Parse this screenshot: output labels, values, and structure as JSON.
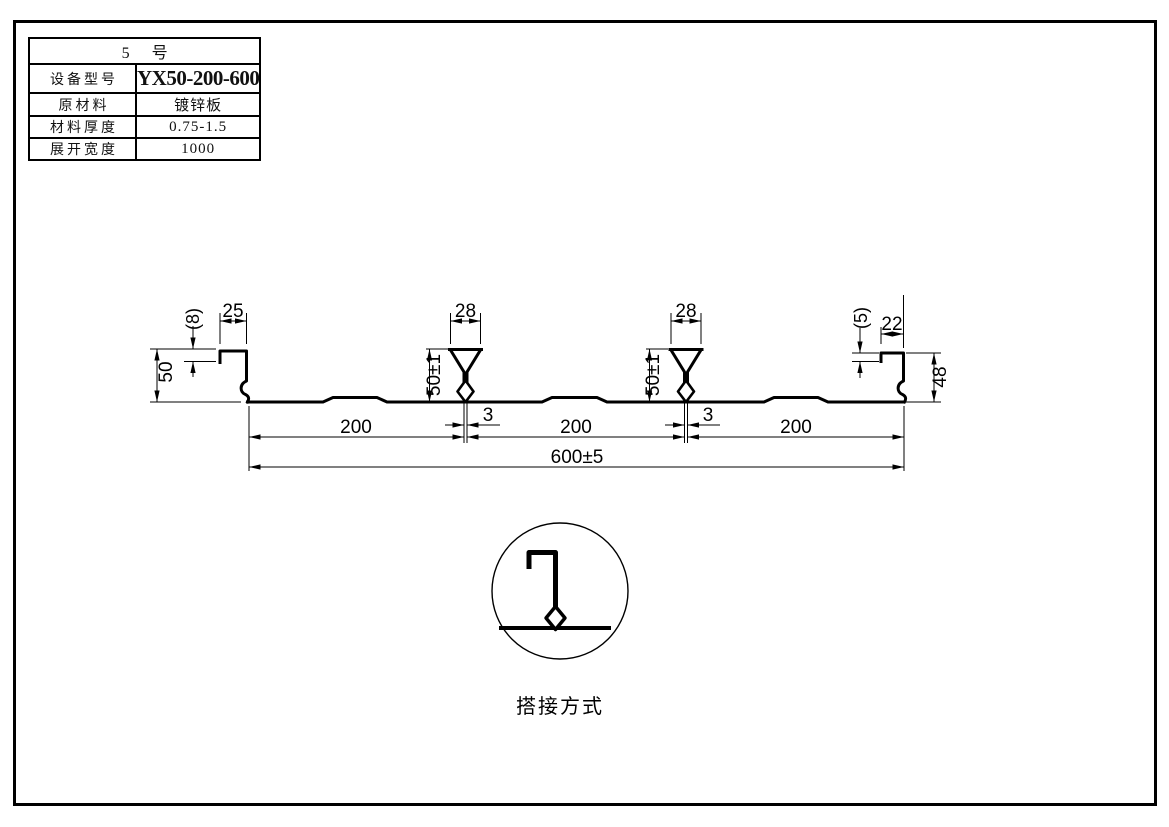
{
  "spec_table": {
    "title": "5 号",
    "rows": [
      {
        "label": "设备型号",
        "value": "YX50-200-600"
      },
      {
        "label": "原材料",
        "value": "镀锌板"
      },
      {
        "label": "材料厚度",
        "value": "0.75-1.5"
      },
      {
        "label": "展开宽度",
        "value": "1000"
      }
    ]
  },
  "drawing": {
    "stroke_color": "#000000",
    "dims": {
      "left_lip_width": "25",
      "left_hook_height": "(8)",
      "left_rib_height": "50",
      "rib1_top_width": "28",
      "rib1_height": "50±1",
      "rib1_slot": "3",
      "rib2_top_width": "28",
      "rib2_height": "50±1",
      "rib2_slot": "3",
      "pitch_1": "200",
      "pitch_2": "200",
      "pitch_3": "200",
      "overall_width": "600±5",
      "right_lip_width": "22",
      "right_hook_height": "(5)",
      "right_rib_height": "48"
    },
    "detail_caption": "搭接方式"
  }
}
